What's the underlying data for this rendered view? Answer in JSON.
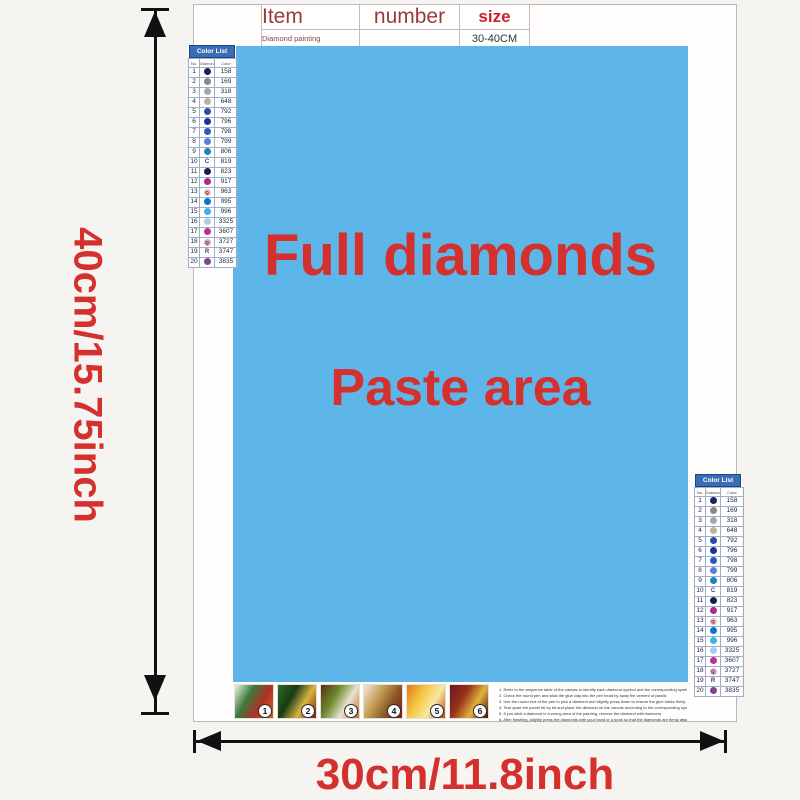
{
  "colors": {
    "paste_bg": "#5db5e8",
    "accent_red": "#d4302e",
    "table_header_red": "#9c3a3a",
    "size_red": "#cc1f2d",
    "list_header_bg": "#3a6db5"
  },
  "item_table": {
    "headers": [
      "Item",
      "number",
      "size"
    ],
    "row": {
      "item": "Diamond painting",
      "number": "",
      "size": "30-40CM"
    }
  },
  "paste_area": {
    "line1": "Full diamonds",
    "line2": "Paste area"
  },
  "dimension_labels": {
    "height": "40cm/15.75inch",
    "width": "30cm/11.8inch"
  },
  "color_list": {
    "title": "Color List",
    "col_headers": [
      "No.",
      "Diamond",
      "Color"
    ],
    "rows": [
      {
        "no": "1",
        "symbol": "",
        "dot": "#16245c",
        "code": "158"
      },
      {
        "no": "2",
        "symbol": "",
        "dot": "#8a8a8a",
        "code": "169"
      },
      {
        "no": "3",
        "symbol": "",
        "dot": "#a8a8a8",
        "code": "318"
      },
      {
        "no": "4",
        "symbol": "",
        "dot": "#b9b3a2",
        "code": "648"
      },
      {
        "no": "5",
        "symbol": "",
        "dot": "#2f4aa8",
        "code": "792"
      },
      {
        "no": "6",
        "symbol": "",
        "dot": "#1e2f9e",
        "code": "796"
      },
      {
        "no": "7",
        "symbol": "",
        "dot": "#2b59c4",
        "code": "798"
      },
      {
        "no": "8",
        "symbol": "",
        "dot": "#5c7fd6",
        "code": "799"
      },
      {
        "no": "9",
        "symbol": "",
        "dot": "#1d84c0",
        "code": "806"
      },
      {
        "no": "10",
        "symbol": "C",
        "dot": "",
        "code": "819"
      },
      {
        "no": "11",
        "symbol": "",
        "dot": "#141f4d",
        "code": "823"
      },
      {
        "no": "12",
        "symbol": "",
        "dot": "#ad2a8b",
        "code": "917"
      },
      {
        "no": "13",
        "symbol": "Q",
        "dot": "#f2b6c6",
        "code": "963"
      },
      {
        "no": "14",
        "symbol": "",
        "dot": "#0b76d0",
        "code": "995"
      },
      {
        "no": "15",
        "symbol": "",
        "dot": "#3eb1ec",
        "code": "996"
      },
      {
        "no": "16",
        "symbol": "",
        "dot": "#a9cdeb",
        "code": "3325"
      },
      {
        "no": "17",
        "symbol": "",
        "dot": "#bb2f97",
        "code": "3607"
      },
      {
        "no": "18",
        "symbol": "Q",
        "dot": "#d9a8c4",
        "code": "3727"
      },
      {
        "no": "19",
        "symbol": "R",
        "dot": "",
        "code": "3747"
      },
      {
        "no": "20",
        "symbol": "",
        "dot": "#7e4791",
        "code": "3835"
      }
    ]
  },
  "steps": [
    {
      "label": "1",
      "colors": [
        "#f5f2ea",
        "#3a7a3a",
        "#b03028",
        "#d8641f"
      ]
    },
    {
      "label": "2",
      "colors": [
        "#2f6b24",
        "#1a3a14",
        "#d8b542",
        "#7a1c12"
      ]
    },
    {
      "label": "3",
      "colors": [
        "#58301a",
        "#6a8a2c",
        "#e8e2d0",
        "#c96a1e"
      ]
    },
    {
      "label": "4",
      "colors": [
        "#efe9dc",
        "#c9a05a",
        "#8a5a26",
        "#801824"
      ]
    },
    {
      "label": "5",
      "colors": [
        "#e07a1a",
        "#f5c743",
        "#f8e8a0",
        "#b64a10"
      ]
    },
    {
      "label": "6",
      "colors": [
        "#701425",
        "#96321c",
        "#e2b23c",
        "#401010"
      ]
    }
  ],
  "instructions": {
    "lines": [
      "1. Refer to the sequence table of the canvas to identify each diamond symbol and the corresponding symbol number on the canvas",
      "2. Check the round pen and stick the glue clay into the pen head by away the cement of plastic",
      "3. Use the round end of the pen to pick a diamond and slightly press down to ensure the glue sticks firmly",
      "4. Tear apart the parcel bit by bit and place the diamond on the canvas according to the corresponding symbol",
      "5. If you stick a diamond in a wrong area of the painting, remove the diamond with tweezers",
      "6. After finishing, slightly press the diamonds with your hand or a book so that the diamonds are firmly attached"
    ]
  }
}
